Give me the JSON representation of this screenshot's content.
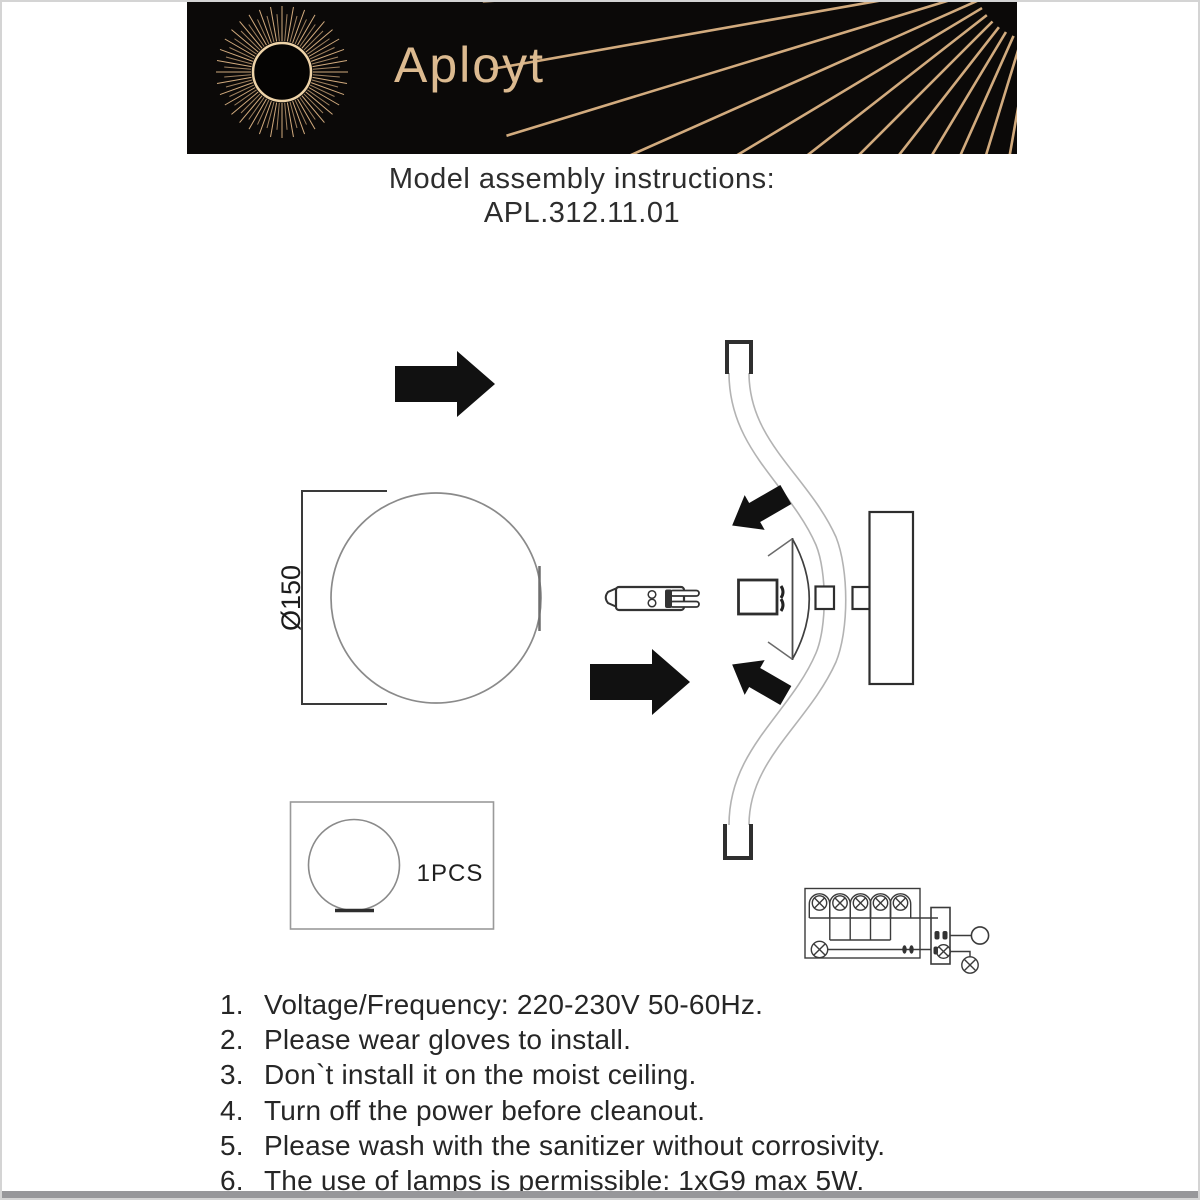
{
  "page": {
    "background": "#ffffff",
    "header_background": "#0b0908",
    "accent_gold": "#d2ab7e",
    "text_color": "#262626"
  },
  "header": {
    "brand": "Aployt",
    "logo": "sunburst-icon"
  },
  "title": {
    "line1": "Model assembly instructions:",
    "line2": "APL.312.11.01"
  },
  "diagram": {
    "front_view": {
      "dimension_label": "Ø150"
    },
    "package_box": {
      "quantity_label": "1PCS"
    }
  },
  "instructions": {
    "items": [
      {
        "num": "1.",
        "text": "Voltage/Frequency: 220-230V 50-60Hz."
      },
      {
        "num": "2.",
        "text": "Please wear gloves to install."
      },
      {
        "num": "3.",
        "text": "Don`t install it on the moist ceiling."
      },
      {
        "num": "4.",
        "text": "Turn off the power before cleanout."
      },
      {
        "num": "5.",
        "text": "Please wash with the sanitizer without corrosivity."
      },
      {
        "num": "6.",
        "text": "The use of lamps is permissible: 1xG9 max 5W."
      }
    ]
  }
}
